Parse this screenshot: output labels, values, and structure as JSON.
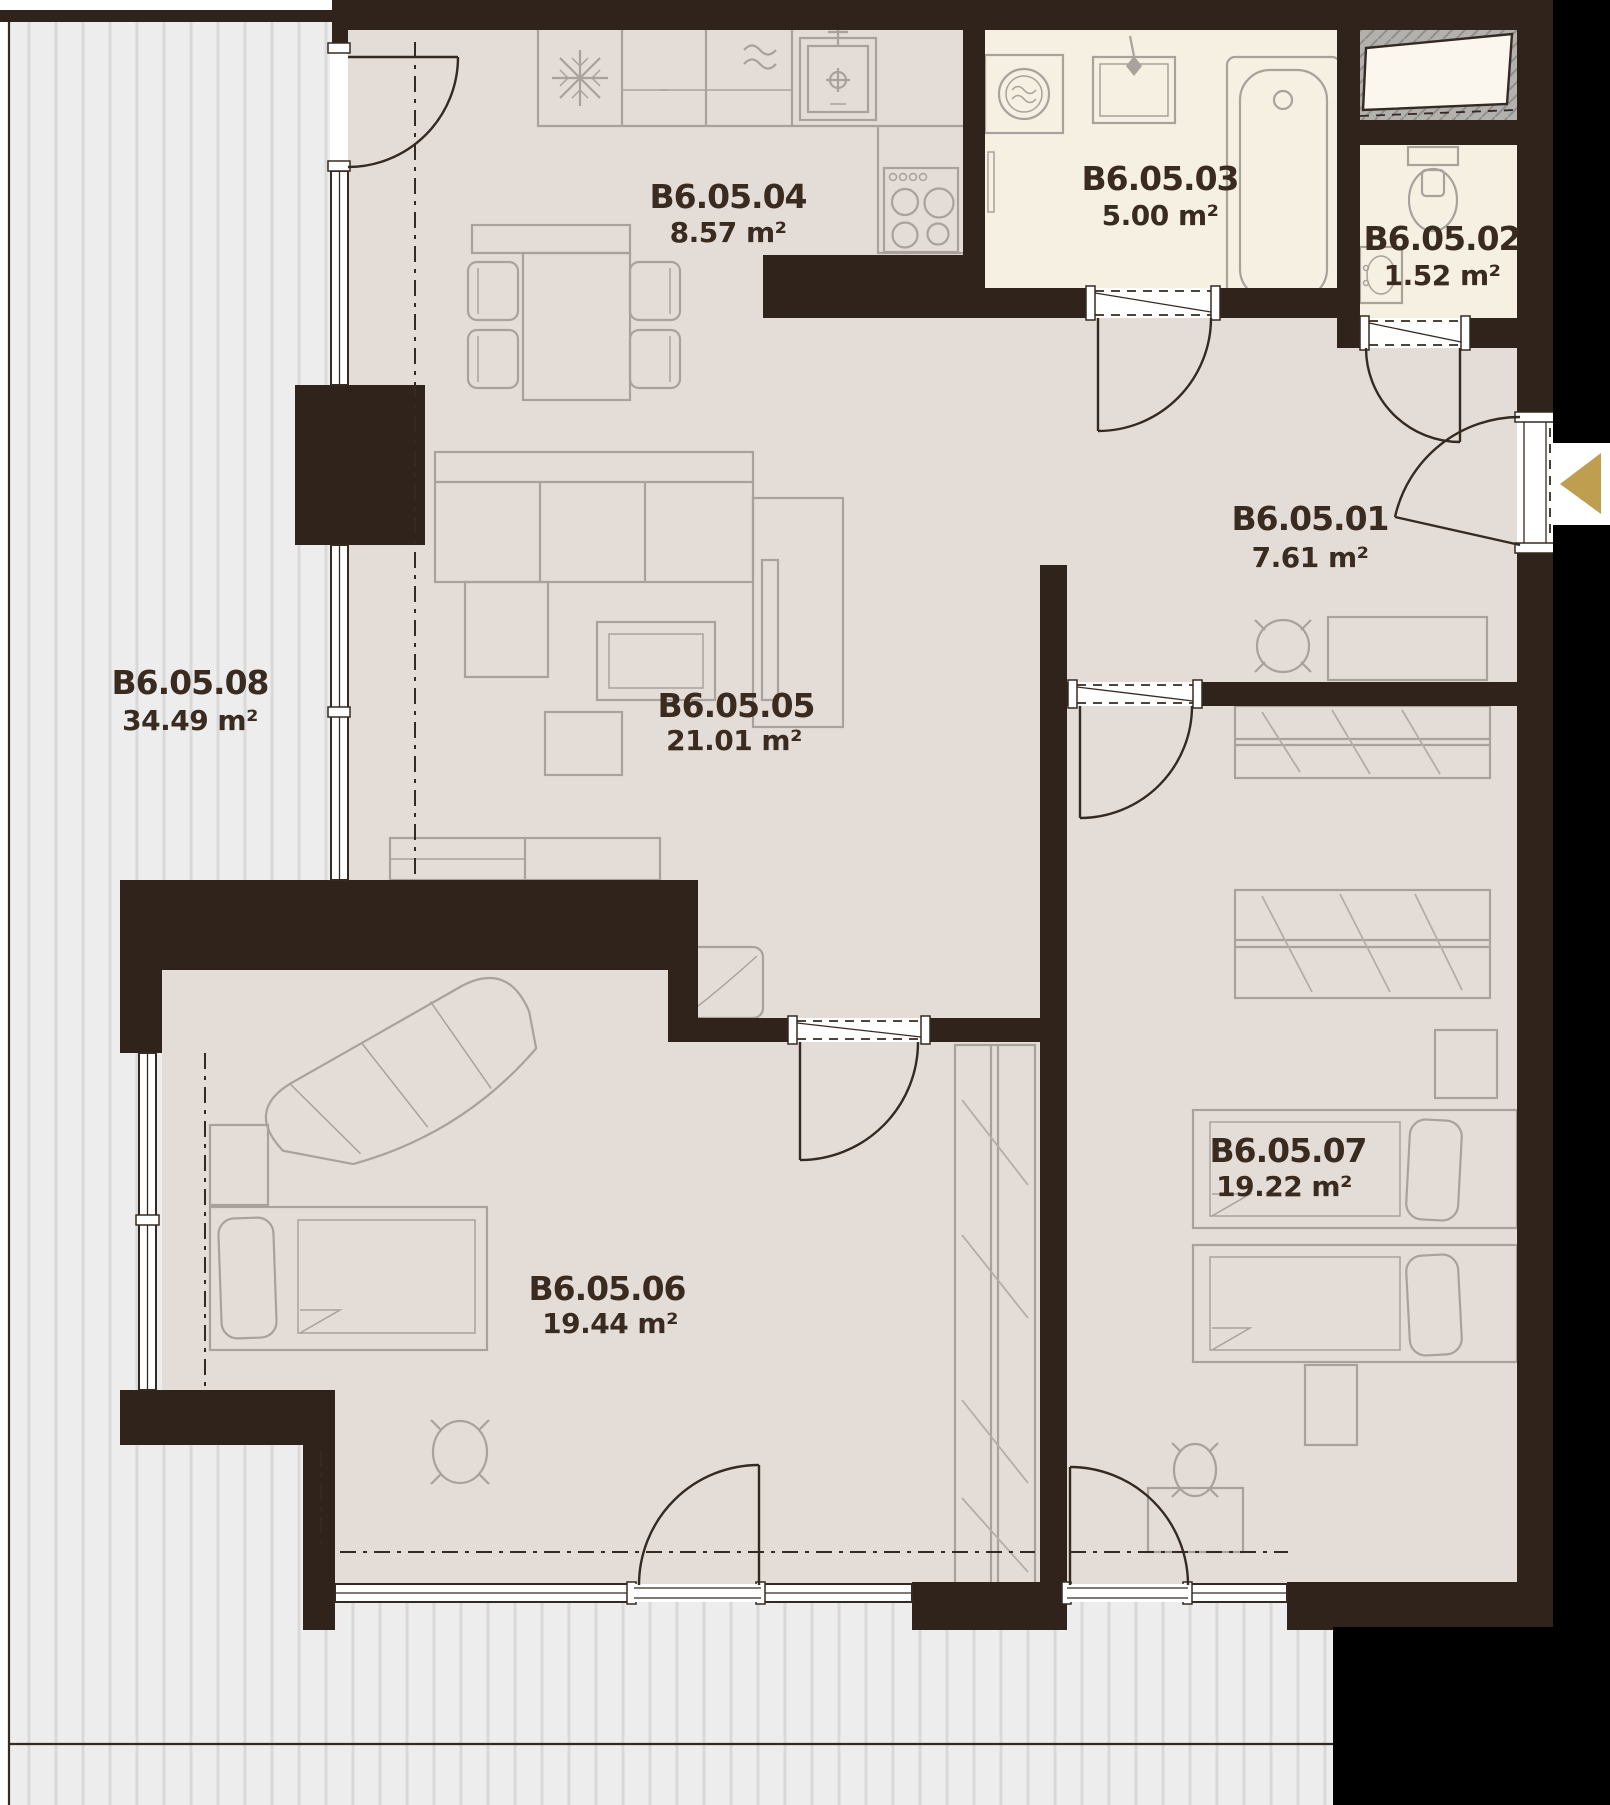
{
  "plan": {
    "name": "Apartment unit floor plan",
    "unit": "B6.05",
    "area_unit": "m²"
  },
  "rooms": [
    {
      "key": "entry-hall",
      "code": "B6.05.01",
      "area": "7.61 m²"
    },
    {
      "key": "wc",
      "code": "B6.05.02",
      "area": "1.52 m²"
    },
    {
      "key": "bathroom",
      "code": "B6.05.03",
      "area": "5.00 m²"
    },
    {
      "key": "kitchen",
      "code": "B6.05.04",
      "area": "8.57 m²"
    },
    {
      "key": "living-room",
      "code": "B6.05.05",
      "area": "21.01 m²"
    },
    {
      "key": "bedroom-1",
      "code": "B6.05.06",
      "area": "19.44 m²"
    },
    {
      "key": "bedroom-2",
      "code": "B6.05.07",
      "area": "19.22 m²"
    },
    {
      "key": "terrace",
      "code": "B6.05.08",
      "area": "34.49 m²"
    }
  ],
  "icons": {
    "entry_arrow": "left-pointing triangle marking apartment entrance",
    "fridge": "snowflake symbol",
    "stove": "four burner circles",
    "washing_machine": "drum circle with waves",
    "bathtub": "rounded tub outline",
    "toilet": "bowl with cistern",
    "washbasin": "small wall basin"
  },
  "colors": {
    "wall": "#2f231b",
    "black": "#000000",
    "floor": "#e4dcd6",
    "wet_floor": "#f6f0e2",
    "terrace": "#ededed",
    "terrace_stripe": "#d9d9d9",
    "shaft_fill": "#b3b1ae",
    "furniture_line": "#a9a19b",
    "wardrobe_line": "#b4aca6",
    "door_line": "#352a21",
    "label_text": "#3a2b21",
    "accent": "#bf9e50",
    "background": "#ffffff"
  }
}
